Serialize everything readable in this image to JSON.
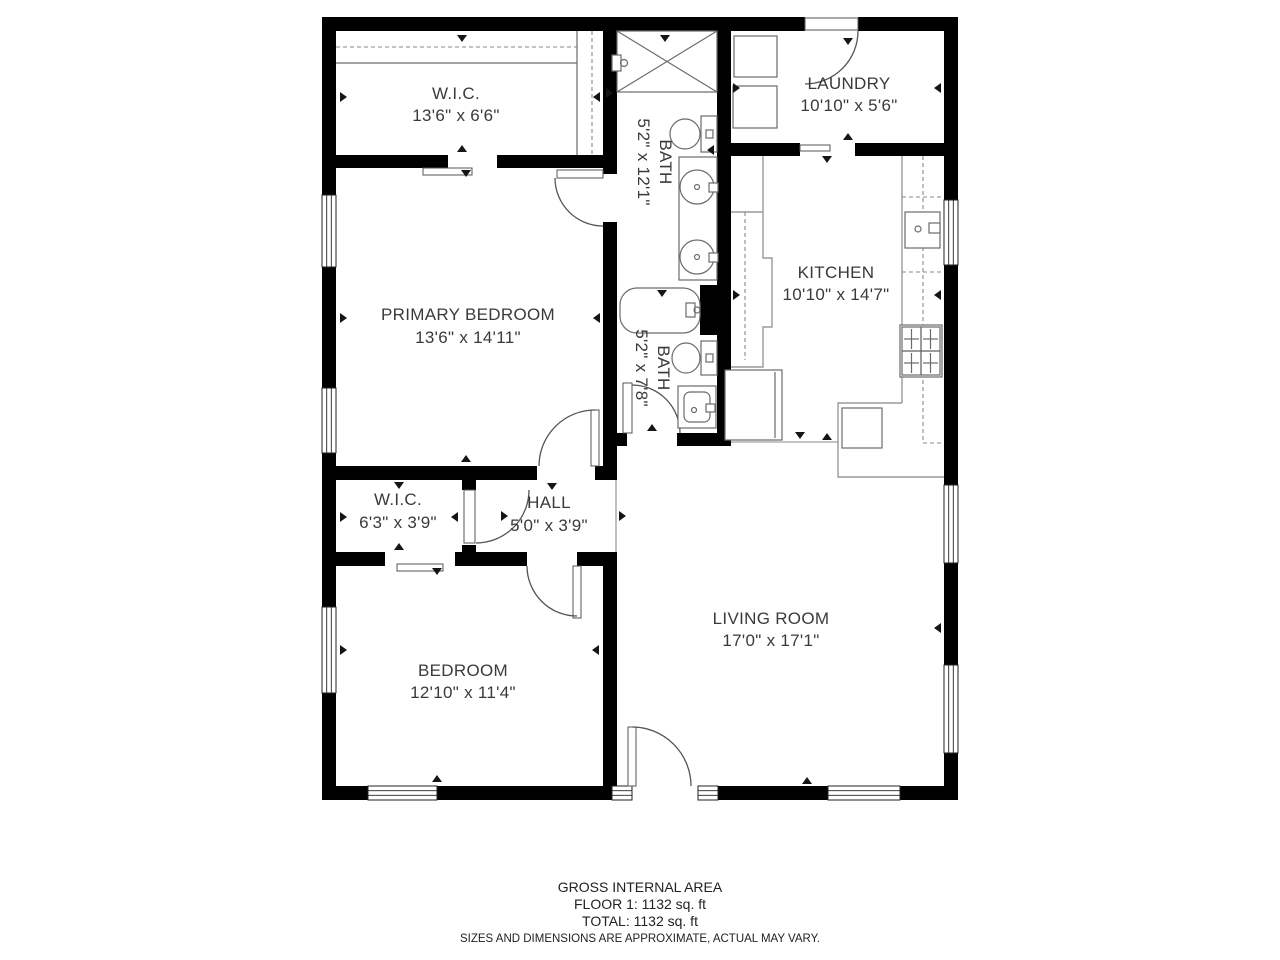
{
  "plan": {
    "rooms": {
      "wic1": {
        "name": "W.I.C.",
        "dims": "13'6\" x 6'6\""
      },
      "bath1": {
        "name": "BATH",
        "dims": "5'2\" x 12'1\""
      },
      "laundry": {
        "name": "LAUNDRY",
        "dims": "10'10\" x 5'6\""
      },
      "primary_bedroom": {
        "name": "PRIMARY BEDROOM",
        "dims": "13'6\" x 14'11\""
      },
      "kitchen": {
        "name": "KITCHEN",
        "dims": "10'10\" x 14'7\""
      },
      "bath2": {
        "name": "BATH",
        "dims": "5'2\" x 7'8\""
      },
      "wic2": {
        "name": "W.I.C.",
        "dims": "6'3\" x 3'9\""
      },
      "hall": {
        "name": "HALL",
        "dims": "5'0\" x 3'9\""
      },
      "bedroom": {
        "name": "BEDROOM",
        "dims": "12'10\" x 11'4\""
      },
      "living_room": {
        "name": "LIVING ROOM",
        "dims": "17'0\" x 17'1\""
      }
    },
    "colors": {
      "wall": "#000000",
      "fixture": "#6b6b6b",
      "label": "#3a3a3a"
    }
  },
  "footer": {
    "line1": "GROSS INTERNAL AREA",
    "line2": "FLOOR 1: 1132 sq. ft",
    "line3": "TOTAL: 1132 sq. ft",
    "disclaimer": "SIZES AND DIMENSIONS ARE APPROXIMATE, ACTUAL MAY VARY."
  }
}
